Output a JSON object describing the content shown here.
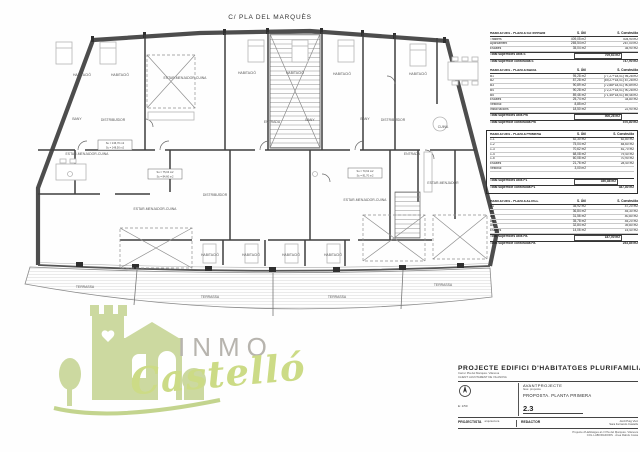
{
  "street_label": "C/ PLA DEL MARQUÈS",
  "plan": {
    "labels": {
      "habitacio": "HABITACIÓ",
      "bany": "BANY",
      "cuina": "CUINA",
      "entrada": "ENTRADA",
      "distribuidor": "DISTRIBUÏDOR",
      "estar_menjador_cuina": "ESTAR-MENJADOR-CUINA",
      "estar_menjador": "ESTAR-MENJADOR",
      "terrassa": "TERRASSA"
    },
    "tags": [
      {
        "a": "Su = 136,70 m2",
        "b": "Sc = 148,50 m2"
      },
      {
        "a": "Su = 75,04 m2",
        "b": "Sc = 84,60 m2"
      },
      {
        "a": "Su = 70,62 m2",
        "b": "Sc = 81,70 m2"
      }
    ]
  },
  "tables": [
    {
      "title": "HABITATGES - PLANTA SOTERRANI",
      "col_util": "S. Útil",
      "col_constr": "S. Construïda",
      "boxed": false,
      "gap_before_totals": false,
      "rows": [
        [
          "Trasters",
          "409,05 m2",
          "404,90 m2"
        ],
        [
          "Aparcament",
          "265,54 m2",
          "267,00 m2"
        ],
        [
          "Escales",
          "35,04 m2",
          "35,90 m2"
        ]
      ],
      "totals": [
        [
          "Total superfícies útils S",
          "709,63 m2"
        ],
        [
          "Total superfície construïda S",
          "747,90 m2"
        ]
      ]
    },
    {
      "title": "HABITATGES - PLANTA BAIXA",
      "col_util": "S. Útil",
      "col_constr": "S. Construïda",
      "boxed": false,
      "gap_before_totals": false,
      "rows": [
        [
          "B1",
          "95,28 m2",
          "(77,27+18,01) 95,28 m2"
        ],
        [
          "B2",
          "87,28 m2",
          "(69,27+18,01) 87,28 m2"
        ],
        [
          "B3",
          "90,89 m2",
          "(72,88+18,01) 90,89 m2"
        ],
        [
          "B4",
          "90,28 m2",
          "(72,27+18,01) 90,28 m2"
        ],
        [
          "B5",
          "89,46 m2",
          "(71,45+18,01) 89,46 m2"
        ],
        [
          "Escales",
          "25,74 m2",
          "34,80 m2"
        ],
        [
          "Vestíbul",
          "8,85 m2",
          ""
        ],
        [
          "Instal·lacions",
          "18,50 m2",
          "22,90 m2"
        ]
      ],
      "totals": [
        [
          "Total superfícies útils PB",
          "506,28 m2"
        ],
        [
          "Total superfície construïda PB",
          "570,80 m2"
        ]
      ]
    },
    {
      "title": "HABITATGES - PLANTA PRIMERA",
      "col_util": "S. Útil",
      "col_constr": "S. Construïda",
      "boxed": true,
      "gap_before_totals": true,
      "rows": [
        [
          "1-1",
          "52,30 m2",
          "62,80 m2"
        ],
        [
          "1-2",
          "75,04 m2",
          "84,60 m2"
        ],
        [
          "1-3",
          "70,62 m2",
          "81,70 m2"
        ],
        [
          "1-4",
          "68,08 m2",
          "79,40 m2"
        ],
        [
          "1-5",
          "60,08 m2",
          "70,90 m2"
        ],
        [
          "Escales",
          "21,76 m2",
          "28,40 m2"
        ],
        [
          "Vestíbul",
          "3,00 m2",
          ""
        ]
      ],
      "totals": [
        [
          "Total superfícies útils P1",
          "350,88 m2"
        ],
        [
          "Total superfície construïda P1",
          "387,80 m2"
        ]
      ]
    },
    {
      "title": "HABITATGES - PLANTA ALTELL",
      "col_util": "S. Útil",
      "col_constr": "S. Construïda",
      "boxed": false,
      "gap_before_totals": false,
      "rows": [
        [
          "A1",
          "35,92 m2",
          "47,20 m2"
        ],
        [
          "A2",
          "36,84 m2",
          "45,30 m2"
        ],
        [
          "A3",
          "31,56 m2",
          "40,80 m2"
        ],
        [
          "A4",
          "35,78 m2",
          "45,20 m2"
        ],
        [
          "A5",
          "32,84 m2",
          "39,80 m2"
        ],
        [
          "Escales",
          "14,06 m2",
          "15,40 m2"
        ]
      ],
      "totals": [
        [
          "Total superfícies útils PA",
          "187,00 m2"
        ],
        [
          "Total superfície construïda PA",
          "253,85 m2"
        ]
      ]
    }
  ],
  "watermark": {
    "top": "INMO",
    "script": "Castelló",
    "colors": {
      "green": "#ccd9a0",
      "green_text": "#ccdb86",
      "gray_text": "#b7b4ae"
    }
  },
  "titleblock": {
    "title": "PROJECTE EDIFICI D'HABITATGES PLURIFAMILIAR",
    "subtitle1": "Carrer Pla del Marquès. Vilanova",
    "subtitle2": "CLIENT: AJUNTAMENT DE VILANOVA",
    "phase_label": "AVANTPROJECTE",
    "phase_note": "fase: proposta",
    "drawing_title": "PROPOSTA. PLANTA PRIMERA",
    "sheet_number": "2.3",
    "scale": "E: 1/50",
    "projectista_label": "PROJECTISTA",
    "projectista_note": "arquitectura",
    "redactor_label": "REDACTOR",
    "redactor_name1": "Jordi Puig Vivó",
    "redactor_name2": "Sara Ferrando Castells",
    "footer1": "Projecte d'Habitatges al c/ Pla del Marquès. Vilanova",
    "footer2": "COL·LABORADORS · Àrea Rafols Costa"
  }
}
